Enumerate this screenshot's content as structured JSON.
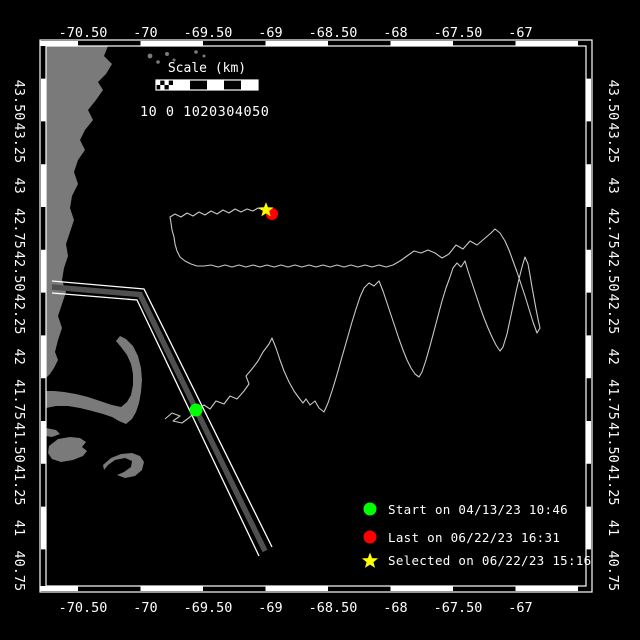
{
  "window": {
    "width": 640,
    "height": 640
  },
  "colors": {
    "background": "#000000",
    "land": "#7a7a7a",
    "track": "#c8c8c8",
    "frame": "#ffffff",
    "text": "#ffffff",
    "lane_line": "#ffffff",
    "lane_stripe": "#4f4f4f",
    "start_marker": "#00ff00",
    "last_marker": "#ff0000",
    "selected_marker": "#ffff00"
  },
  "axes": {
    "lon_labels": [
      "-70.50",
      "-70",
      "-69.50",
      "-69",
      "-68.50",
      "-68",
      "-67.50",
      "-67"
    ],
    "lat_labels": [
      "43.50",
      "43.25",
      "43",
      "42.75",
      "42.50",
      "42.25",
      "42",
      "41.75",
      "41.50",
      "41.25",
      "41",
      "40.75"
    ]
  },
  "scale_bar": {
    "title": "Scale (km)",
    "tick_text": "10 0 1020304050"
  },
  "legend": {
    "items": [
      {
        "marker": "circle",
        "color": "#00ff00",
        "label": "Start on 04/13/23 10:46"
      },
      {
        "marker": "circle",
        "color": "#ff0000",
        "label": "Last on 06/22/23 16:31"
      },
      {
        "marker": "star",
        "color": "#ffff00",
        "label": "Selected on 06/22/23 15:16"
      }
    ]
  },
  "map_data": {
    "type": "track-map",
    "land_paths": [
      "M46,46 L108,46 L104,56 L112,64 L106,74 L98,82 L103,90 L96,100 L88,110 L93,120 L85,130 L80,140 L85,150 L78,160 L74,172 L78,184 L72,196 L70,208 L74,220 L70,232 L66,244 L68,256 L64,268 L62,280 L66,292 L62,304 L58,316 L62,328 L58,340 L55,352 L58,360 L54,368 L50,374 L46,378 Z",
      "M46,408 L56,406 L68,406 L80,408 L92,411 L103,414 L112,417 L119,421 L126,424 L132,419 L136,412 L139,403 L141,392 L142,380 L141,368 L138,356 L133,346 L126,339 L120,336 L116,341 L121,347 L127,355 L131,364 L133,374 L133,385 L131,395 L127,402 L121,407 L112,405 L100,401 L88,397 L76,394 L64,392 L54,391 L46,391 Z",
      "M46,428 L56,430 L60,434 L52,437 L46,436 Z",
      "M49,446 L58,439 L70,437 L80,438 L86,442 L82,447 L87,451 L83,456 L73,460 L61,462 L52,459 L48,453 Z",
      "M103,465 L111,458 L121,454 L132,453 L140,456 L144,462 L142,470 L135,476 L125,478 L117,475 L124,472 L131,467 L132,461 L125,458 L115,460 L108,465 L104,470 Z"
    ],
    "islands": [
      [
        150,
        56,
        2.4
      ],
      [
        158,
        62,
        1.8
      ],
      [
        167,
        54,
        2.0
      ],
      [
        174,
        60,
        1.5
      ],
      [
        196,
        52,
        1.8
      ],
      [
        204,
        56,
        1.5
      ],
      [
        65,
        178,
        1.5
      ]
    ],
    "lane": {
      "white_lines": [
        "52,281 144,289 272,547",
        "52,293 137,300 259,556"
      ],
      "stripe": "52,287 140,294.5 265,551"
    },
    "track_points": "165,419 172,413 180,416 173,421 182,423 190,417 196,410 204,405 210,409 216,401 224,404 230,396 237,399 244,391 249,384 246,376 252,369 258,361 263,352 269,344 272,338 276,348 280,360 284,371 289,382 294,391 299,398 303,403 306,399 310,405 315,401 319,408 324,412 328,403 332,391 336,378 340,364 344,350 348,336 352,322 356,309 360,297 364,288 369,283 374,286 379,281 383,291 387,303 391,315 395,327 399,339 403,350 407,360 411,368 415,374 419,377 422,372 426,360 430,346 434,331 438,316 442,301 446,288 450,277 453,268 457,263 461,267 465,261 468,271 472,283 476,295 480,307 484,318 488,328 492,337 496,345 500,351 503,347 507,334 510,320 513,306 516,292 519,279 522,267 525,257 528,264 530,275 532,287 534,298 536,309 538,319 540,328 537,333 533,322 529,309 525,296 521,284 517,272 513,261 509,250 505,241 500,233 495,229 491,233 484,239 477,245 470,241 463,249 456,245 449,254 442,258 435,253 428,250 421,253 414,251 407,256 400,261 393,265 386,267 379,265 372,267 365,265 358,267 351,265 344,267 337,265 330,267 323,265 316,267 309,265 302,267 295,265 288,267 281,265 274,267 267,265 260,267 253,265 246,267 239,265 232,267 225,265 218,267 211,265 204,266 197,266 191,264 185,261 180,257 177,251 175,244 174,237 172,230 171,223 170,217 175,214 181,217 187,213 193,216 199,212 205,215 211,211 217,214 223,210 229,213 235,209 241,212 247,209 253,211 258,208 263,210 268,212 271,213",
    "markers": {
      "start": [
        196,
        410
      ],
      "last": [
        272,
        214
      ],
      "selected": [
        266,
        210
      ]
    }
  }
}
